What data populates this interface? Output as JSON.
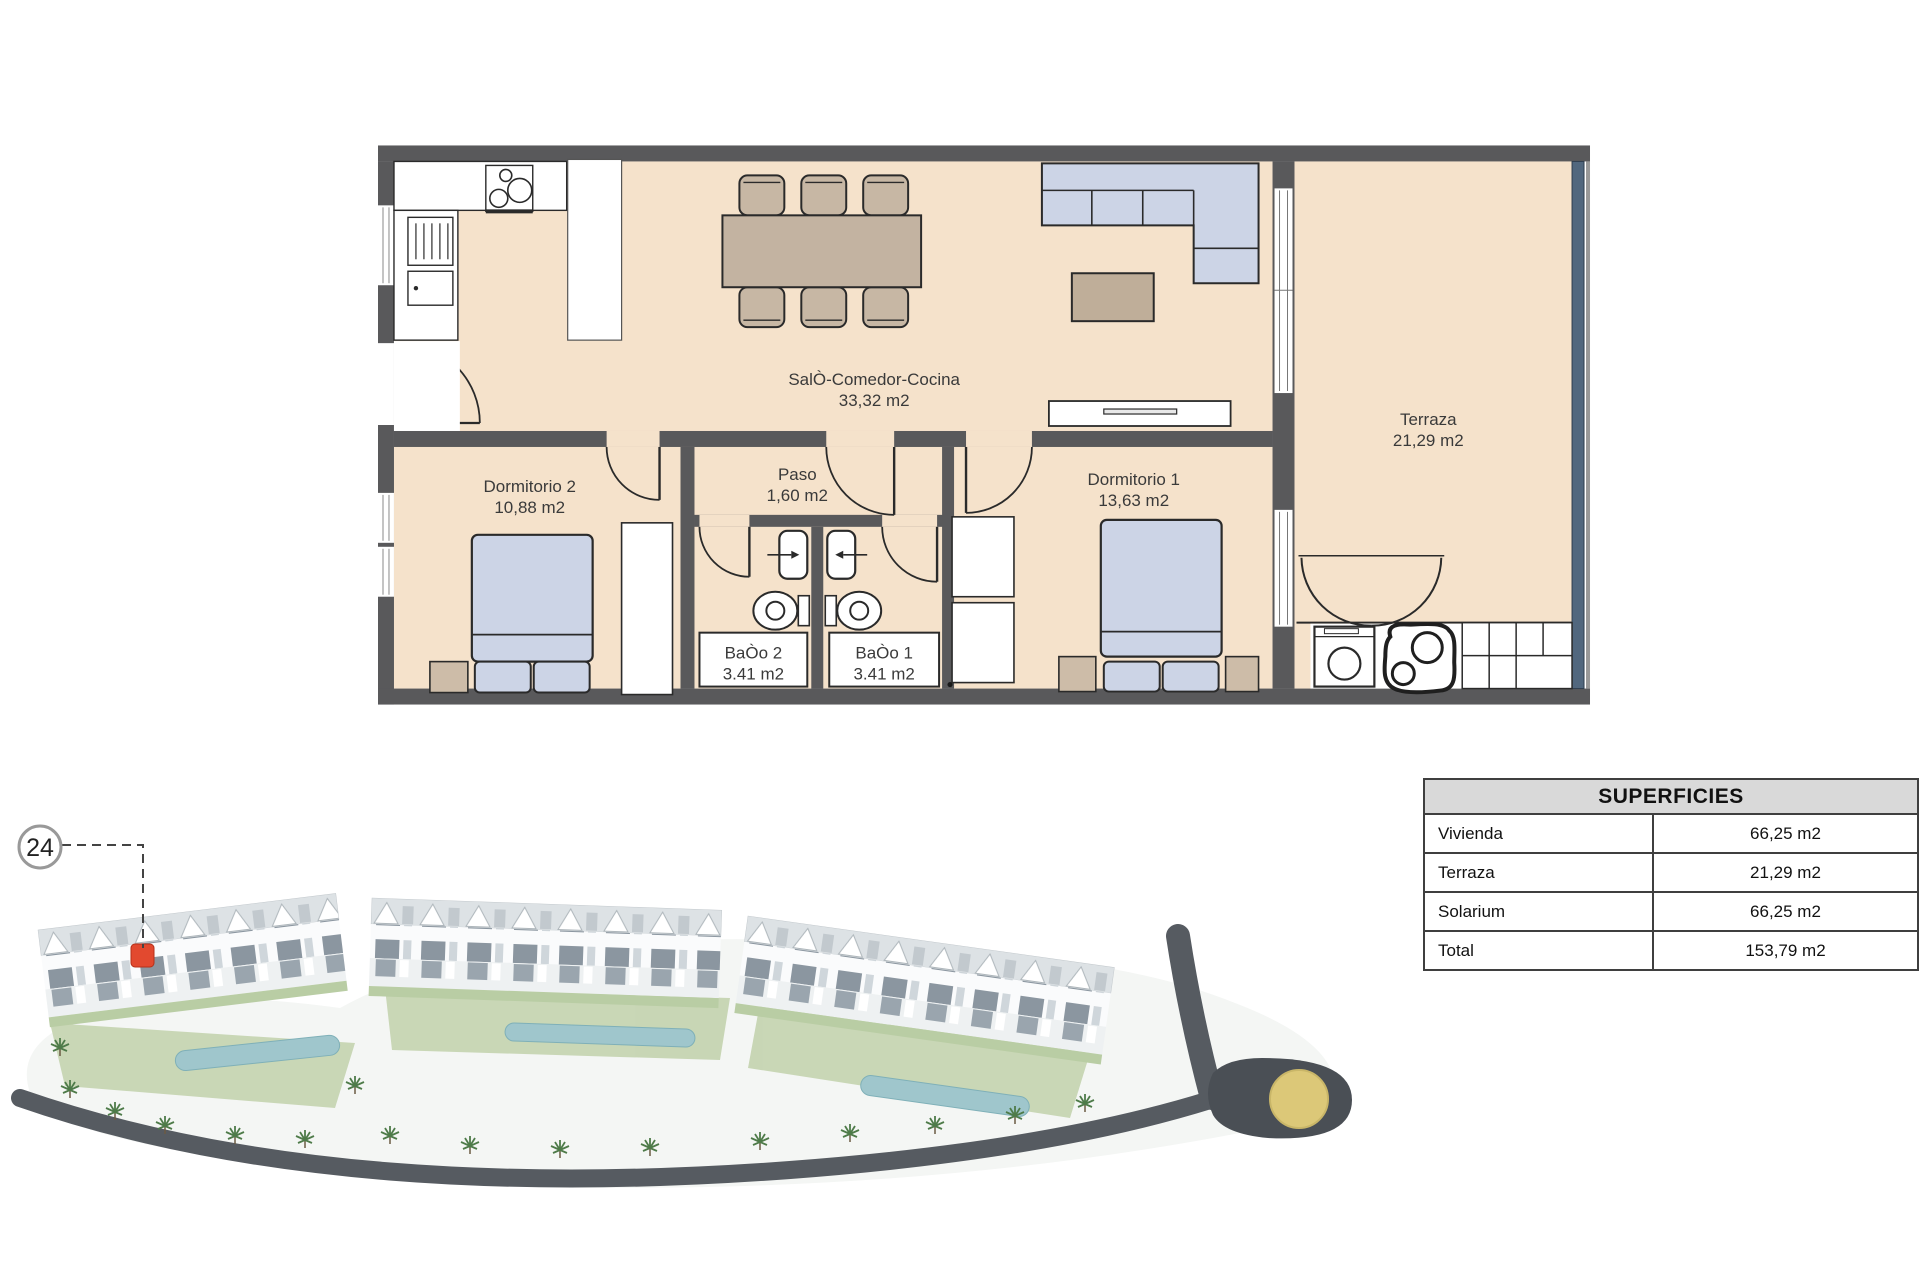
{
  "floorplan": {
    "rooms": {
      "salon": {
        "name": "SalÒ-Comedor-Cocina",
        "area": "33,32 m2"
      },
      "terraza": {
        "name": "Terraza",
        "area": "21,29 m2"
      },
      "dormitorio2": {
        "name": "Dormitorio 2",
        "area": "10,88 m2"
      },
      "paso": {
        "name": "Paso",
        "area": "1,60 m2"
      },
      "dormitorio1": {
        "name": "Dormitorio 1",
        "area": "13,63 m2"
      },
      "bano2": {
        "name": "BaÒo 2",
        "area": "3.41 m2"
      },
      "bano1": {
        "name": "BaÒo 1",
        "area": "3.41 m2"
      }
    }
  },
  "site_plan": {
    "unit_badge": "24"
  },
  "superficies": {
    "title": "SUPERFICIES",
    "rows": [
      {
        "label": "Vivienda",
        "value": "66,25 m2"
      },
      {
        "label": "Terraza",
        "value": "21,29 m2"
      },
      {
        "label": "Solarium",
        "value": "66,25 m2"
      },
      {
        "label": "Total",
        "value": "153,79 m2"
      }
    ]
  },
  "colors": {
    "floor": "#f5e2cb",
    "wall": "#59595b",
    "furniture_blue": "#ccd4e6",
    "furniture_tan": "#c3b3a1",
    "terrace_railing": "#51677e",
    "unit_marker_red": "#e2492f",
    "roundabout_yellow": "#dcc878",
    "table_header_bg": "#d9d9d9"
  }
}
